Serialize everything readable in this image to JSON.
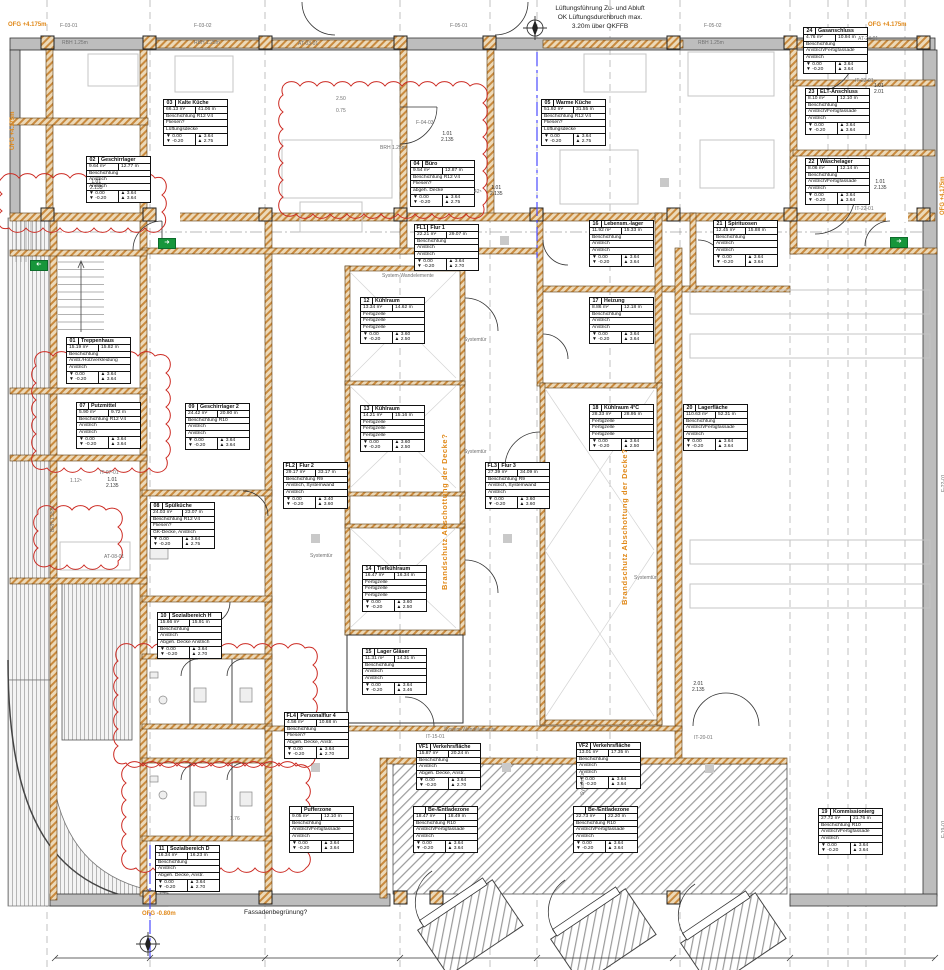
{
  "colors": {
    "wall_hatch": "#c98a3e",
    "revision_cloud": "#cc2a22",
    "annotation_orange": "#e08818",
    "exit_green": "#17963b",
    "section_blue": "#4b4bff"
  },
  "icons": {
    "exit_arrow": "➜"
  },
  "level_icons": {
    "floor": "▼",
    "ceiling": "▲"
  },
  "rooms": [
    {
      "id": "01",
      "num": "01",
      "name": "Treppenhaus",
      "area": "15.19 m²",
      "perimeter": "15.82 m",
      "finishes": [
        "Beschichtung",
        "Anstr./Holzverkleidung",
        "Anstrich"
      ],
      "levels": [
        [
          "0.00",
          "3.64"
        ],
        [
          "-0.20",
          "3.64"
        ]
      ]
    },
    {
      "id": "02",
      "num": "02",
      "name": "Geschirrlager",
      "area": "9.64 m²",
      "perimeter": "12.77 m",
      "finishes": [
        "Beschichtung",
        "Anstrich",
        "Anstrich"
      ],
      "levels": [
        [
          "0.00",
          "3.64"
        ],
        [
          "-0.20",
          "3.64"
        ]
      ]
    },
    {
      "id": "03",
      "num": "03",
      "name": "Kalte Küche",
      "area": "66.13 m²",
      "perimeter": "41.06 m",
      "finishes": [
        "Beschichtung R12 V4",
        "Fliesen?",
        "Lüftungsdecke"
      ],
      "levels": [
        [
          "0.00",
          "3.64"
        ],
        [
          "-0.20",
          "2.75"
        ]
      ]
    },
    {
      "id": "04",
      "num": "04",
      "name": "Büro",
      "area": "9.54 m²",
      "perimeter": "12.87 m",
      "finishes": [
        "Beschichtung R12 V4",
        "Fliesen?",
        "abgeh. Decke"
      ],
      "levels": [
        [
          "0.00",
          "3.64"
        ],
        [
          "-0.20",
          "2.75"
        ]
      ]
    },
    {
      "id": "05",
      "num": "05",
      "name": "Warme Küche",
      "area": "51.92 m²",
      "perimeter": "31.55 m",
      "finishes": [
        "Beschichtung R12 V4",
        "Fliesen?",
        "Lüftungsdecke"
      ],
      "levels": [
        [
          "0.00",
          "3.64"
        ],
        [
          "-0.20",
          "2.75"
        ]
      ]
    },
    {
      "id": "07",
      "num": "07",
      "name": "Putzmittel",
      "area": "5.90 m²",
      "perimeter": "9.72 m",
      "finishes": [
        "Beschichtung R12 V4",
        "Anstrich",
        "Anstrich"
      ],
      "levels": [
        [
          "0.00",
          "3.64"
        ],
        [
          "-0.20",
          "3.64"
        ]
      ]
    },
    {
      "id": "08",
      "num": "08",
      "name": "Spülküche",
      "area": "24.03 m²",
      "perimeter": "23.07 m",
      "finishes": [
        "Beschichtung R12 V4",
        "Fliesen?",
        "GK-Decke, Anstrich"
      ],
      "levels": [
        [
          "0.00",
          "3.64"
        ],
        [
          "-0.20",
          "2.75"
        ]
      ]
    },
    {
      "id": "09",
      "num": "09",
      "name": "Geschirrlager 2",
      "area": "24.42 m²",
      "perimeter": "20.90 m",
      "finishes": [
        "Beschichtung R10",
        "Anstrich",
        "Anstrich"
      ],
      "levels": [
        [
          "0.00",
          "3.64"
        ],
        [
          "-0.20",
          "3.64"
        ]
      ]
    },
    {
      "id": "10",
      "num": "10",
      "name": "Sozialbereich H",
      "area": "15.66 m²",
      "perimeter": "15.91 m",
      "finishes": [
        "Beschichtung",
        "Anstrich",
        "Abgeh. Decke Anstrich"
      ],
      "levels": [
        [
          "0.00",
          "3.64"
        ],
        [
          "-0.20",
          "2.70"
        ]
      ]
    },
    {
      "id": "11",
      "num": "11",
      "name": "Sozialbereich D",
      "area": "16.34 m²",
      "perimeter": "16.23 m",
      "finishes": [
        "Beschichtung",
        "Anstrich",
        "Abgeh. Decke, Anstr."
      ],
      "levels": [
        [
          "0.00",
          "3.64"
        ],
        [
          "-0.20",
          "2.70"
        ]
      ]
    },
    {
      "id": "12",
      "num": "12",
      "name": "Kühlraum",
      "area": "13.34 m²",
      "perimeter": "14.62 m",
      "finishes": [
        "Fertigzelle",
        "Fertigzelle",
        "Fertigzelle"
      ],
      "levels": [
        [
          "0.00",
          "3.60"
        ],
        [
          "-0.20",
          "2.50"
        ]
      ]
    },
    {
      "id": "13",
      "num": "13",
      "name": "Kühlraum",
      "area": "14.21 m²",
      "perimeter": "15.16 m",
      "finishes": [
        "Fertigzelle",
        "Fertigzelle",
        "Fertigzelle"
      ],
      "levels": [
        [
          "0.00",
          "3.60"
        ],
        [
          "-0.20",
          "2.50"
        ]
      ]
    },
    {
      "id": "14",
      "num": "14",
      "name": "Tiefkühlraum",
      "area": "16.47 m²",
      "perimeter": "16.34 m",
      "finishes": [
        "Fertigzelle",
        "Fertigzelle",
        "Fertigzelle"
      ],
      "levels": [
        [
          "0.00",
          "3.60"
        ],
        [
          "-0.20",
          "2.50"
        ]
      ]
    },
    {
      "id": "15",
      "num": "15",
      "name": "Lager Gläser",
      "area": "11.31 m²",
      "perimeter": "14.31 m",
      "finishes": [
        "Beschichtung",
        "Anstrich",
        "Anstrich"
      ],
      "levels": [
        [
          "0.00",
          "3.64"
        ],
        [
          "-0.20",
          "3.46"
        ]
      ]
    },
    {
      "id": "16",
      "num": "16",
      "name": "Lebensm.-lager",
      "area": "11.92 m²",
      "perimeter": "15.33 m",
      "finishes": [
        "Beschichtung",
        "Anstrich",
        "Anstrich"
      ],
      "levels": [
        [
          "0.00",
          "3.64"
        ],
        [
          "-0.20",
          "3.64"
        ]
      ]
    },
    {
      "id": "17",
      "num": "17",
      "name": "Heizung",
      "area": "8.86 m²",
      "perimeter": "12.18 m",
      "finishes": [
        "Beschichtung",
        "Anstrich",
        "Anstrich"
      ],
      "levels": [
        [
          "0.00",
          "3.64"
        ],
        [
          "-0.20",
          "3.64"
        ]
      ]
    },
    {
      "id": "18",
      "num": "18",
      "name": "Kühlraum 4°C",
      "area": "28.33 m²",
      "perimeter": "28.95 m",
      "finishes": [
        "Fertigzelle",
        "Fertigzelle",
        "Fertigzelle"
      ],
      "levels": [
        [
          "0.00",
          "3.64"
        ],
        [
          "-0.20",
          "2.50"
        ]
      ]
    },
    {
      "id": "19",
      "num": "19",
      "name": "Kommissionierg",
      "area": "27.72 m²",
      "perimeter": "21.76 m",
      "finishes": [
        "Beschichtung R10",
        "Anstrich/Fertigfassade",
        "Anstrich"
      ],
      "levels": [
        [
          "0.00",
          "3.64"
        ],
        [
          "-0.20",
          "3.64"
        ]
      ]
    },
    {
      "id": "20",
      "num": "20",
      "name": "Lagerfläche",
      "area": "110.63 m²",
      "perimeter": "52.31 m",
      "finishes": [
        "Beschichtung",
        "Anstrich/Fertigfassade",
        "Anstrich"
      ],
      "levels": [
        [
          "0.00",
          "3.64"
        ],
        [
          "-0.20",
          "3.64"
        ]
      ]
    },
    {
      "id": "21",
      "num": "21",
      "name": "Spirituosen",
      "area": "12.45 m²",
      "perimeter": "15.88 m",
      "finishes": [
        "Beschichtung",
        "Anstrich",
        "Anstrich"
      ],
      "levels": [
        [
          "0.00",
          "3.64"
        ],
        [
          "-0.20",
          "3.64"
        ]
      ]
    },
    {
      "id": "22",
      "num": "22",
      "name": "Wäschelager",
      "area": "8.06 m²",
      "perimeter": "12.14 m",
      "finishes": [
        "Beschichtung",
        "Anstrich/Fertigfassade",
        "Anstrich"
      ],
      "levels": [
        [
          "0.00",
          "3.64"
        ],
        [
          "-0.20",
          "3.64"
        ]
      ]
    },
    {
      "id": "23",
      "num": "23",
      "name": "ELT-Anschluss",
      "area": "8.10 m²",
      "perimeter": "12.10 m",
      "finishes": [
        "Beschichtung",
        "Anstrich/Fertigfassade",
        "Anstrich"
      ],
      "levels": [
        [
          "0.00",
          "3.64"
        ],
        [
          "-0.20",
          "3.64"
        ]
      ]
    },
    {
      "id": "24",
      "num": "24",
      "name": "Gasanschluss",
      "area": "4.76 m²",
      "perimeter": "10.94 m",
      "finishes": [
        "Beschichtung",
        "Anstrich/Fertigfassade",
        "Anstrich"
      ],
      "levels": [
        [
          "0.00",
          "3.64"
        ],
        [
          "-0.20",
          "3.64"
        ]
      ]
    },
    {
      "id": "FL1",
      "num": "FL1",
      "name": "Flur 1",
      "area": "22.21 m²",
      "perimeter": "29.07 m",
      "finishes": [
        "Beschichtung",
        "Anstrich",
        "Anstrich"
      ],
      "levels": [
        [
          "0.00",
          "3.64"
        ],
        [
          "-0.20",
          "2.70"
        ]
      ]
    },
    {
      "id": "FL2",
      "num": "FL2",
      "name": "Flur 2",
      "area": "29.17 m²",
      "perimeter": "33.17 m",
      "finishes": [
        "Beschichtung R9",
        "Anstrich, Systemwand",
        "Anstrich"
      ],
      "levels": [
        [
          "0.00",
          "3.40"
        ],
        [
          "-0.20",
          "3.60"
        ]
      ]
    },
    {
      "id": "FL3",
      "num": "FL3",
      "name": "Flur 3",
      "area": "27.39 m²",
      "perimeter": "34.09 m",
      "finishes": [
        "Beschichtung R9",
        "Anstrich, Systemwand",
        "Anstrich"
      ],
      "levels": [
        [
          "0.00",
          "3.60"
        ],
        [
          "-0.20",
          "3.60"
        ]
      ]
    },
    {
      "id": "FL4",
      "num": "FL4",
      "name": "Personalflur 4",
      "area": "4.56 m²",
      "perimeter": "10.68 m",
      "finishes": [
        "Beschichtung",
        "Fliesen?",
        "Abgeh. Decke, Anstr."
      ],
      "levels": [
        [
          "0.00",
          "3.64"
        ],
        [
          "-0.20",
          "2.70"
        ]
      ]
    },
    {
      "id": "VF1",
      "num": "VF1",
      "name": "Verkehrsfläche",
      "area": "15.87 m²",
      "perimeter": "20.24 m",
      "finishes": [
        "Beschichtung",
        "Anstrich",
        "Abgeh. Decke, Anstr."
      ],
      "levels": [
        [
          "0.00",
          "3.64"
        ],
        [
          "-0.20",
          "2.70"
        ]
      ]
    },
    {
      "id": "VF2",
      "num": "VF2",
      "name": "Verkehrsfläche",
      "area": "13.01 m²",
      "perimeter": "17.35 m",
      "finishes": [
        "Beschichtung",
        "Anstrich",
        "Anstrich"
      ],
      "levels": [
        [
          "0.00",
          "3.64"
        ],
        [
          "-0.20",
          "3.64"
        ]
      ]
    },
    {
      "id": "PZ",
      "num": "",
      "name": "Pufferzone",
      "area": "9.05 m²",
      "perimeter": "12.10 m",
      "finishes": [
        "Beschichtung",
        "Anstrich/Fertigfassade",
        "Anstrich"
      ],
      "levels": [
        [
          "0.00",
          "3.64"
        ],
        [
          "-0.20",
          "3.64"
        ]
      ]
    },
    {
      "id": "BE1",
      "num": "",
      "name": "Be-/Entladezone",
      "area": "18.47 m²",
      "perimeter": "18.49 m",
      "finishes": [
        "Beschichtung R10",
        "Anstrich/Fertigfassade",
        "Anstrich"
      ],
      "levels": [
        [
          "0.00",
          "3.64"
        ],
        [
          "-0.20",
          "3.64"
        ]
      ]
    },
    {
      "id": "BE2",
      "num": "",
      "name": "Be-/Entladezone",
      "area": "22.73 m²",
      "perimeter": "22.20 m",
      "finishes": [
        "Beschichtung R10",
        "Anstrich/Fertigfassade",
        "Anstrich"
      ],
      "levels": [
        [
          "0.00",
          "3.64"
        ],
        [
          "-0.20",
          "3.64"
        ]
      ]
    }
  ],
  "annotations": [
    {
      "id": "lueft1",
      "text": "Lüftungsführung Zu- und Abluft"
    },
    {
      "id": "lueft2",
      "text": "OK Lüftungsdurchbruch max."
    },
    {
      "id": "lueft3",
      "text": "3.20m über OKFFB"
    },
    {
      "id": "f0301",
      "text": "F-03-01"
    },
    {
      "id": "f0302",
      "text": "F-03-02"
    },
    {
      "id": "f0501",
      "text": "F-05-01"
    },
    {
      "id": "f0502",
      "text": "F-05-02"
    },
    {
      "id": "f0403",
      "text": "F-04-03"
    },
    {
      "id": "ofgTL",
      "text": "OFG +4.175m"
    },
    {
      "id": "ofgTR",
      "text": "OFG +4.175m"
    },
    {
      "id": "ofgL",
      "text": "OFG +4.175m"
    },
    {
      "id": "ofgR",
      "text": "OFG +4.175m"
    },
    {
      "id": "ofgB",
      "text": "OFG -0.80m"
    },
    {
      "id": "bs1",
      "text": "Brandschutz Abschottung der Decke?"
    },
    {
      "id": "bs2",
      "text": "Brandschutz Abschottung der Decke?"
    },
    {
      "id": "st1",
      "text": "Systemtür"
    },
    {
      "id": "st2",
      "text": "Systemtür"
    },
    {
      "id": "st3",
      "text": "Systemtür"
    },
    {
      "id": "st4",
      "text": "Systemtür"
    },
    {
      "id": "st5",
      "text": "Systemtür"
    },
    {
      "id": "swe1",
      "text": "System-Wandelemente"
    },
    {
      "id": "swe2",
      "text": "System-Wandelemente"
    },
    {
      "id": "fass",
      "text": "Fassadenbegrünung?"
    },
    {
      "id": "rbh1",
      "text": "RBH 1.25m"
    },
    {
      "id": "rbh2",
      "text": "RBH 1.25m"
    },
    {
      "id": "rbh3",
      "text": "RBH 1.25m"
    },
    {
      "id": "brh1",
      "text": "BRH 1.25m"
    },
    {
      "id": "brh2",
      "text": "BRH 1.25m"
    },
    {
      "id": "at03",
      "text": "AT-03-01"
    },
    {
      "id": "at24",
      "text": "AT-24-01"
    },
    {
      "id": "it23",
      "text": "IT-23-01"
    },
    {
      "id": "it22",
      "text": "IT-22-01"
    },
    {
      "id": "it07",
      "text": "IT-07-01"
    },
    {
      "id": "at08",
      "text": "AT-08-01"
    },
    {
      "id": "it15",
      "text": "IT-15-01"
    },
    {
      "id": "it20",
      "text": "IT-20-01"
    },
    {
      "id": "fv1",
      "text": "F-22-01"
    },
    {
      "id": "fv2",
      "text": "F-19-01"
    },
    {
      "id": "d1",
      "text": "1.01\n2.135"
    },
    {
      "id": "d2",
      "text": "42⁵"
    },
    {
      "id": "d3",
      "text": "1.01\n2.135"
    },
    {
      "id": "d4",
      "text": "1.01\n2.135"
    },
    {
      "id": "d5",
      "text": "1.01\n2.01"
    },
    {
      "id": "d6",
      "text": "1.01\n2.135"
    },
    {
      "id": "d7",
      "text": "1.12⁵"
    },
    {
      "id": "d8",
      "text": "1.01\n2.135"
    },
    {
      "id": "d9",
      "text": "2.50"
    },
    {
      "id": "d10",
      "text": "0.75"
    },
    {
      "id": "d11",
      "text": "2.01\n2.135"
    },
    {
      "id": "d12",
      "text": "1.76"
    }
  ]
}
